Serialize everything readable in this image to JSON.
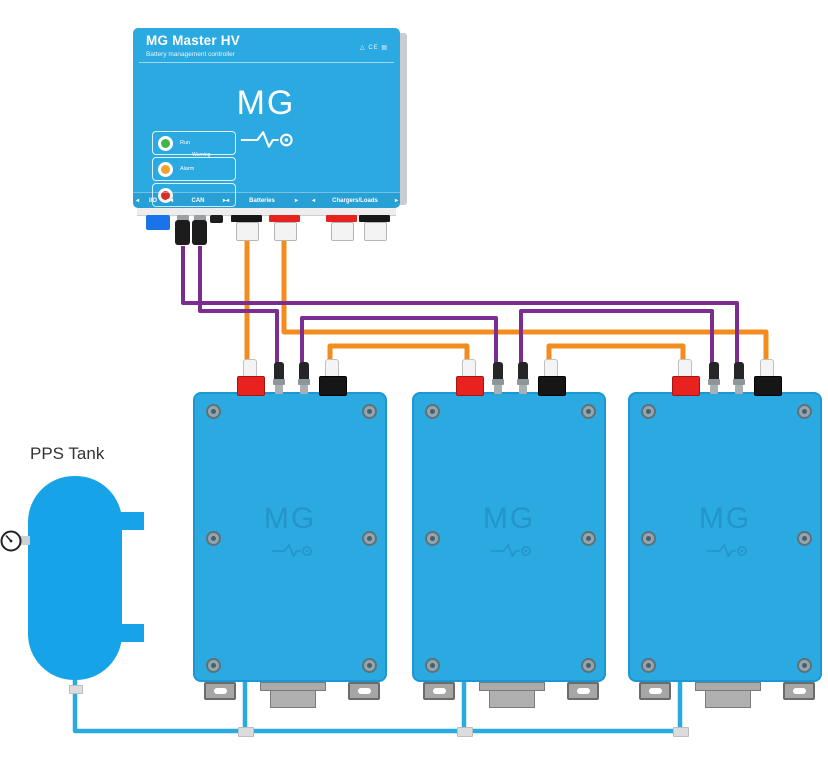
{
  "master": {
    "title": "MG Master HV",
    "subtitle": "Battery management controller",
    "certifications": "△ CE ▤",
    "logo_text": "MG",
    "warning_caption": "Warning",
    "leds": [
      {
        "label": "Run",
        "color": "#3db54a"
      },
      {
        "label": "Alarm",
        "color": "#f0a32c"
      },
      {
        "label": "",
        "color": "#dd3526"
      }
    ],
    "ports": {
      "io": "I/O",
      "can": "CAN",
      "batteries": "Batteries",
      "chargers_loads": "Chargers/Loads"
    }
  },
  "battery": {
    "logo_text": "MG"
  },
  "tank": {
    "label": "PPS Tank"
  },
  "colors": {
    "device_blue": "#2ba9e1",
    "tank_blue": "#17a3e8",
    "io_connector_blue": "#1a73e8",
    "terminal_red": "#e8231f",
    "terminal_black": "#161616",
    "wire_orange": "#f28c1e",
    "wire_purple": "#7b2d90",
    "coolant_blue": "#29abe2"
  },
  "wires": [
    {
      "name": "power-master-to-battery1-positive",
      "color": "orange",
      "points": [
        [
          247,
          240
        ],
        [
          247,
          362
        ]
      ]
    },
    {
      "name": "power-master-to-battery3-negative",
      "color": "orange",
      "points": [
        [
          284,
          240
        ],
        [
          284,
          332
        ],
        [
          766,
          332
        ],
        [
          766,
          360
        ]
      ]
    },
    {
      "name": "series-link-battery1-to-battery2",
      "color": "orange",
      "points": [
        [
          330,
          360
        ],
        [
          330,
          346
        ],
        [
          467,
          346
        ],
        [
          467,
          360
        ]
      ]
    },
    {
      "name": "series-link-battery2-to-battery3",
      "color": "orange",
      "points": [
        [
          549,
          360
        ],
        [
          549,
          346
        ],
        [
          683,
          346
        ],
        [
          683,
          360
        ]
      ]
    },
    {
      "name": "can-master-to-battery3",
      "color": "purple",
      "points": [
        [
          183,
          246
        ],
        [
          183,
          303
        ],
        [
          737,
          303
        ],
        [
          737,
          364
        ]
      ]
    },
    {
      "name": "can-master-to-battery1",
      "color": "purple",
      "points": [
        [
          200,
          246
        ],
        [
          200,
          311
        ],
        [
          277,
          311
        ],
        [
          277,
          364
        ]
      ]
    },
    {
      "name": "can-battery1-to-battery2",
      "color": "purple",
      "points": [
        [
          302,
          364
        ],
        [
          302,
          318
        ],
        [
          496,
          318
        ],
        [
          496,
          364
        ]
      ]
    },
    {
      "name": "can-battery2-to-battery3",
      "color": "purple",
      "points": [
        [
          521,
          364
        ],
        [
          521,
          311
        ],
        [
          712,
          311
        ],
        [
          712,
          364
        ]
      ]
    },
    {
      "name": "coolant-tank-main-loop",
      "color": "coolant",
      "points": [
        [
          75,
          672
        ],
        [
          75,
          731
        ],
        [
          680,
          731
        ],
        [
          680,
          678
        ]
      ]
    },
    {
      "name": "coolant-battery1-drop",
      "color": "coolant",
      "points": [
        [
          245,
          678
        ],
        [
          245,
          731
        ]
      ]
    },
    {
      "name": "coolant-battery2-drop",
      "color": "coolant",
      "points": [
        [
          464,
          678
        ],
        [
          464,
          731
        ]
      ]
    }
  ]
}
